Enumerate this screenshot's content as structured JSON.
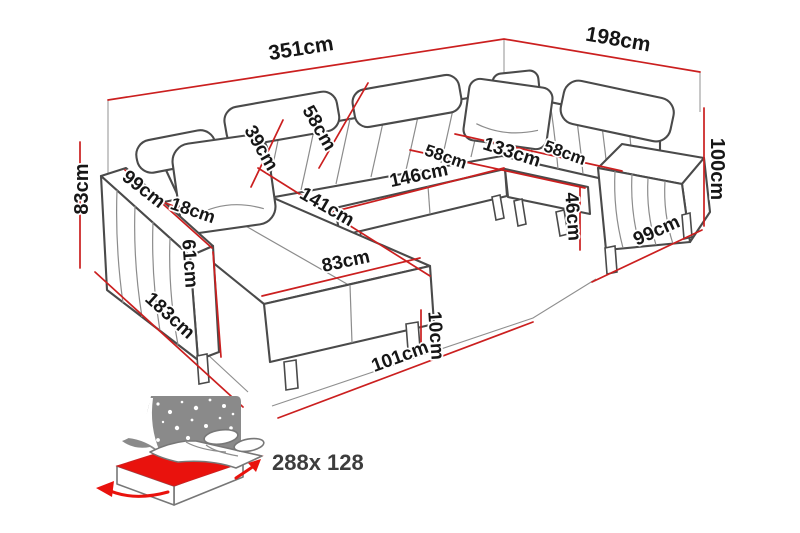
{
  "title": "Corner sofa dimension diagram",
  "unit": "cm",
  "colors": {
    "dimension_line": "#cb1f1f",
    "label_text": "#161616",
    "sofa_outline": "#4a4a4a",
    "sleep_icon_gray": "#8a8a8a",
    "bed_accent": "#e9120d",
    "background": "#ffffff"
  },
  "icons": {
    "sleep_function": "bed-with-starry-headboard-icon"
  },
  "labels": [
    {
      "id": "dim-351-top-left-width",
      "text": "351cm"
    },
    {
      "id": "dim-198-top-right-width",
      "text": "198cm"
    },
    {
      "id": "dim-83-left-height",
      "text": "83cm"
    },
    {
      "id": "dim-100-right-height",
      "text": "100cm"
    },
    {
      "id": "dim-99-left-armrest",
      "text": "99cm"
    },
    {
      "id": "dim-18-armrest-width",
      "text": "18cm"
    },
    {
      "id": "dim-61-armrest-height",
      "text": "61cm"
    },
    {
      "id": "dim-39-backrest",
      "text": "39cm"
    },
    {
      "id": "dim-58-backrest",
      "text": "58cm"
    },
    {
      "id": "dim-141-chaise-length",
      "text": "141cm"
    },
    {
      "id": "dim-83-chaise-width",
      "text": "83cm"
    },
    {
      "id": "dim-183-left-depth",
      "text": "183cm"
    },
    {
      "id": "dim-101-front-edge",
      "text": "101cm"
    },
    {
      "id": "dim-10-leg-height",
      "text": "10cm"
    },
    {
      "id": "dim-58-middle-seat",
      "text": "58cm"
    },
    {
      "id": "dim-146-middle-seat-width",
      "text": "146cm"
    },
    {
      "id": "dim-133-corner-seat",
      "text": "133cm"
    },
    {
      "id": "dim-58-right-seat",
      "text": "58cm"
    },
    {
      "id": "dim-46-seat-height",
      "text": "46cm"
    },
    {
      "id": "dim-99-right-depth",
      "text": "99cm"
    }
  ],
  "sleep_function": {
    "bed_size": "288x 128"
  }
}
